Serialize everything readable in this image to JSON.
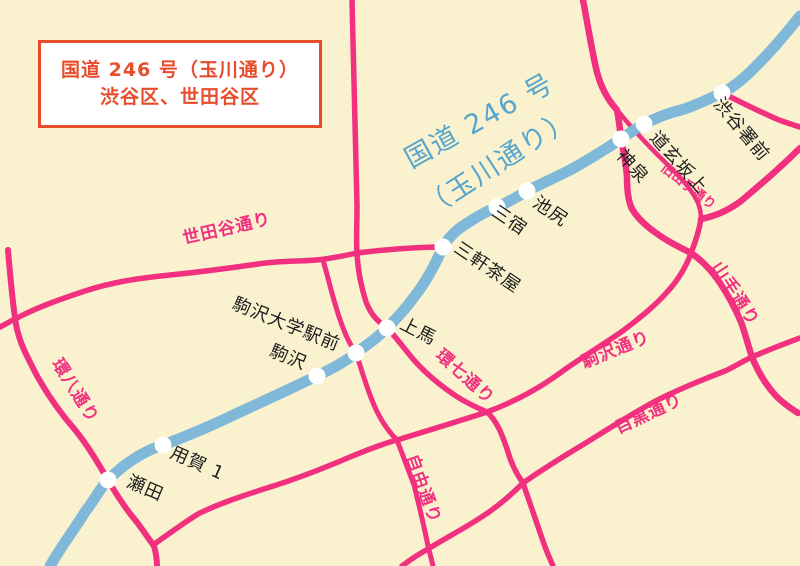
{
  "colors": {
    "background": "#FAF2CF",
    "blue_road": "#7FB8D9",
    "blue_text": "#55A5CC",
    "pink_road": "#F1307F",
    "pink_text": "#F1307F",
    "red_accent": "#E74C2B",
    "station_dot": "#FFFFFF",
    "station_text": "#1F1F1F"
  },
  "title_box": {
    "line1": "国道 246 号（玉川通り）",
    "line2": "渋谷区、世田谷区"
  },
  "route_label": {
    "line1": "国道 246 号",
    "line2": "（玉川通り）"
  },
  "route": {
    "name": "国道246号（玉川通り）"
  },
  "stations": [
    {
      "name": "瀬田"
    },
    {
      "name": "用賀 1"
    },
    {
      "name": "駒沢"
    },
    {
      "name": "駒沢大学駅前"
    },
    {
      "name": "上馬"
    },
    {
      "name": "三軒茶屋"
    },
    {
      "name": "三宿"
    },
    {
      "name": "池尻"
    },
    {
      "name": "神泉"
    },
    {
      "name": "道玄坂上"
    },
    {
      "name": "渋谷署前"
    }
  ],
  "road_labels": [
    {
      "name": "世田谷通り"
    },
    {
      "name": "環八通り"
    },
    {
      "name": "環七通り"
    },
    {
      "name": "自由通り"
    },
    {
      "name": "駒沢通り"
    },
    {
      "name": "目黒通り"
    },
    {
      "name": "山手通り"
    },
    {
      "name": "旧山手通り"
    }
  ]
}
